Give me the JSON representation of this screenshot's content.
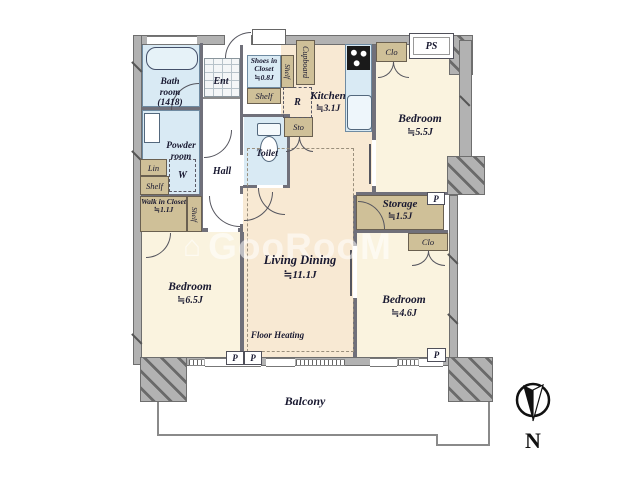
{
  "watermark": {
    "icon": "⌂",
    "text": "GooRooM"
  },
  "compass": {
    "north_label": "N"
  },
  "outdoor": {
    "balcony": "Balcony"
  },
  "boxes": {
    "ps": "PS",
    "pipe_markers": [
      "P",
      "P",
      "P",
      "P"
    ]
  },
  "rooms": {
    "bath": {
      "name": "Bath room",
      "size": "(1418)"
    },
    "entrance": {
      "name": "Ent"
    },
    "shoes_in_closet": {
      "name": "Shoes in Closet",
      "area": "≒0.8J"
    },
    "shelf_beside_shoes": {
      "name": "Shelf"
    },
    "shelf_below_shoes": {
      "name": "Shelf"
    },
    "cupboard": {
      "name": "Cupboard"
    },
    "refrigerator": {
      "name": "R"
    },
    "kitchen": {
      "name": "Kitchen",
      "area": "≒3.1J"
    },
    "sto": {
      "name": "Sto"
    },
    "closet_north": {
      "name": "Clo"
    },
    "bedroom_ne": {
      "name": "Bedroom",
      "area": "≒5.5J"
    },
    "powder_room": {
      "name": "Powder room"
    },
    "washer": {
      "name": "W"
    },
    "toilet": {
      "name": "Toilet"
    },
    "hall": {
      "name": "Hall"
    },
    "linen": {
      "name": "Lin"
    },
    "shelf_linen": {
      "name": "Shelf"
    },
    "walk_in_closet": {
      "name": "Walk in Closet",
      "area": "≒1.1J"
    },
    "shelf_wic": {
      "name": "Shelf"
    },
    "storage": {
      "name": "Storage",
      "area": "≒1.5J"
    },
    "closet_east": {
      "name": "Clo"
    },
    "bedroom_se": {
      "name": "Bedroom",
      "area": "≒4.6J"
    },
    "bedroom_sw": {
      "name": "Bedroom",
      "area": "≒6.5J"
    },
    "living_dining": {
      "name": "Living Dining",
      "area": "≒11.1J"
    },
    "floor_heating": {
      "name": "Floor Heating"
    }
  },
  "colors": {
    "wall": "#b2b2b2",
    "room_cream": "#faf3df",
    "room_peach": "#f8e9d3",
    "water_blue": "#d9eaf4",
    "closet_tan": "#cfc098",
    "line": "#55555e",
    "text": "#181830"
  }
}
